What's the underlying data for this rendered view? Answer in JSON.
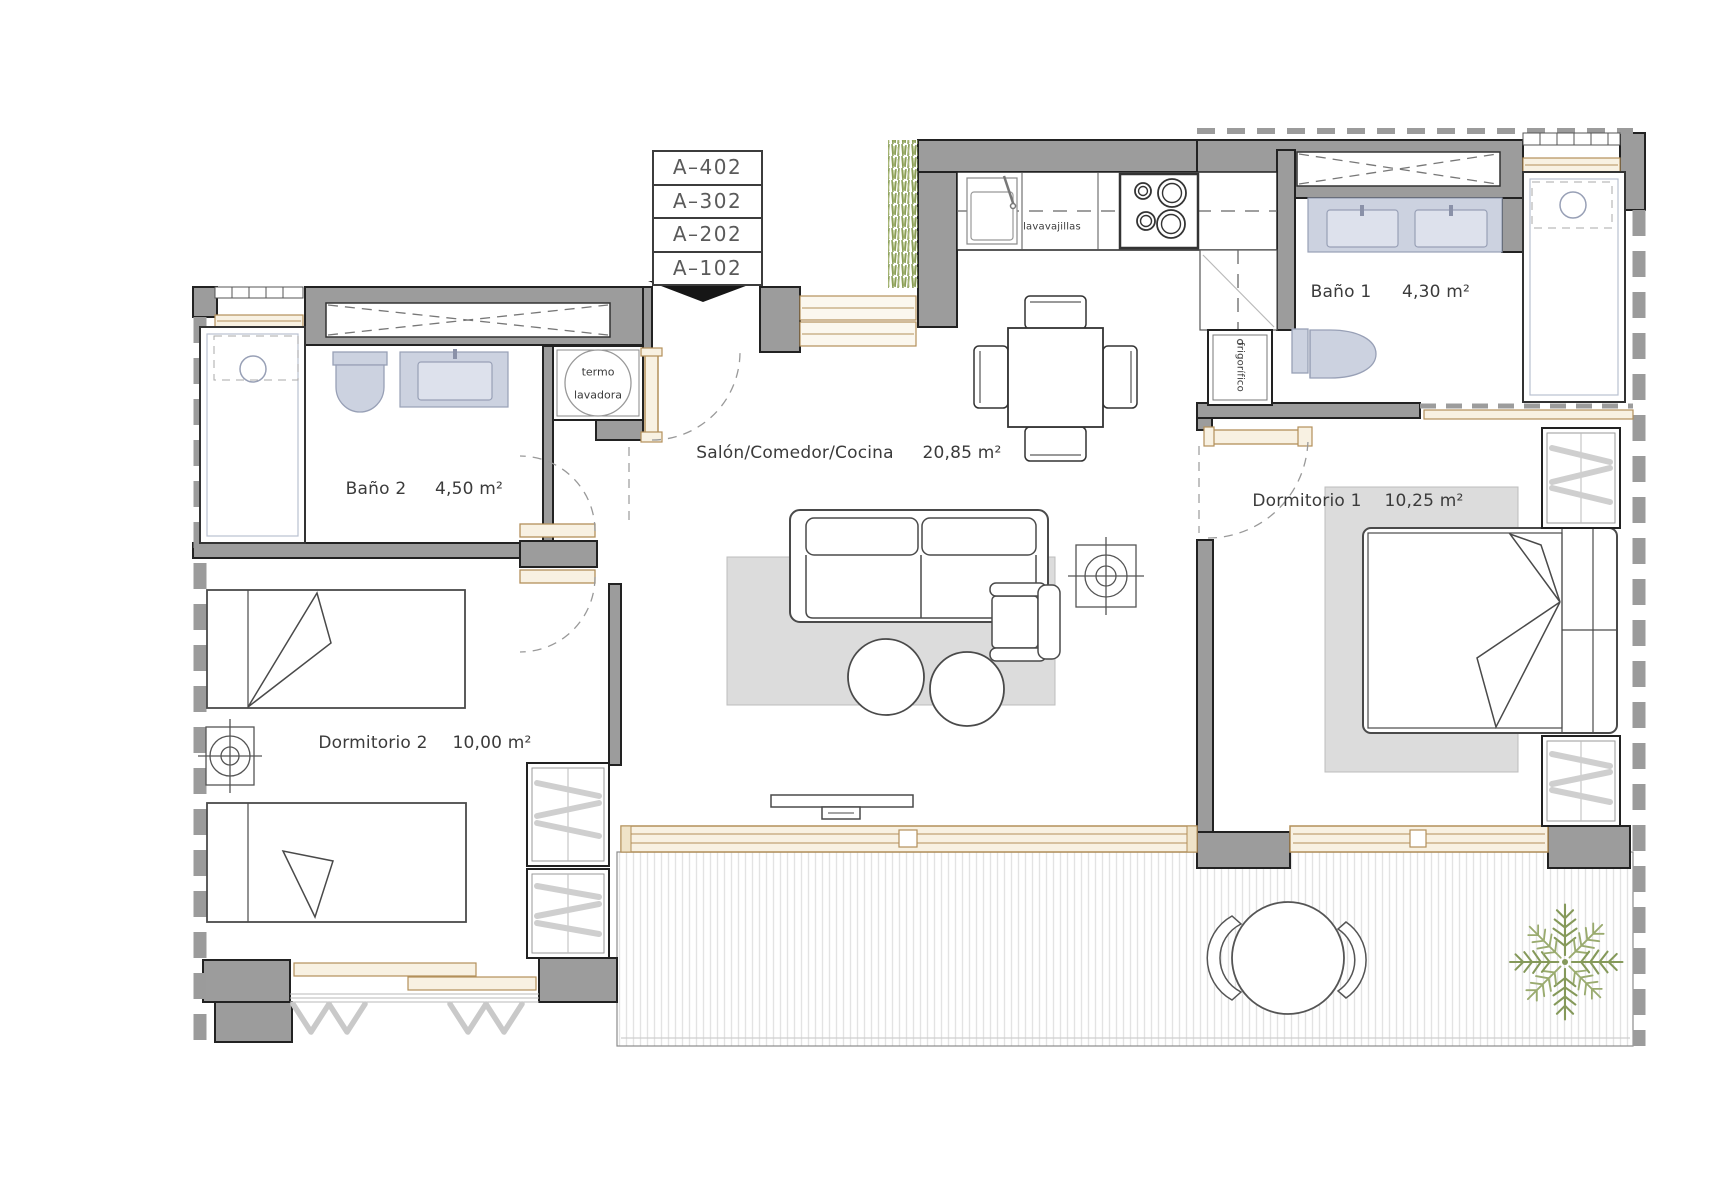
{
  "plan": {
    "unit_labels": [
      "A–402",
      "A–302",
      "A–202",
      "A–102"
    ],
    "rooms": [
      {
        "id": "salon",
        "name": "Salón/Comedor/Cocina",
        "area": "20,85 m²"
      },
      {
        "id": "dormitorio-1",
        "name": "Dormitorio 1",
        "area": "10,25 m²"
      },
      {
        "id": "dormitorio-2",
        "name": "Dormitorio 2",
        "area": "10,00 m²"
      },
      {
        "id": "bano-1",
        "name": "Baño 1",
        "area": "4,30 m²"
      },
      {
        "id": "bano-2",
        "name": "Baño 2",
        "area": "4,50 m²"
      }
    ],
    "appliances": {
      "water_heater": "termo",
      "washer": "lavadora",
      "dishwasher": "lavavajillas",
      "fridge": "frigorífico"
    },
    "colors": {
      "wall": "#9c9c9c",
      "wall_outline": "#222222",
      "fixture_fill": "#ccd2e0",
      "fixture_border": "#98a0b6",
      "rug": "#dcdcdc",
      "wood_trim": "#b3905a",
      "wood_fill": "#f8f1e2",
      "furniture_line": "#4a4a4a",
      "dash": "#999999",
      "grass": "#8a9e57",
      "palm": "#85995a",
      "arrow": "#161616"
    }
  }
}
